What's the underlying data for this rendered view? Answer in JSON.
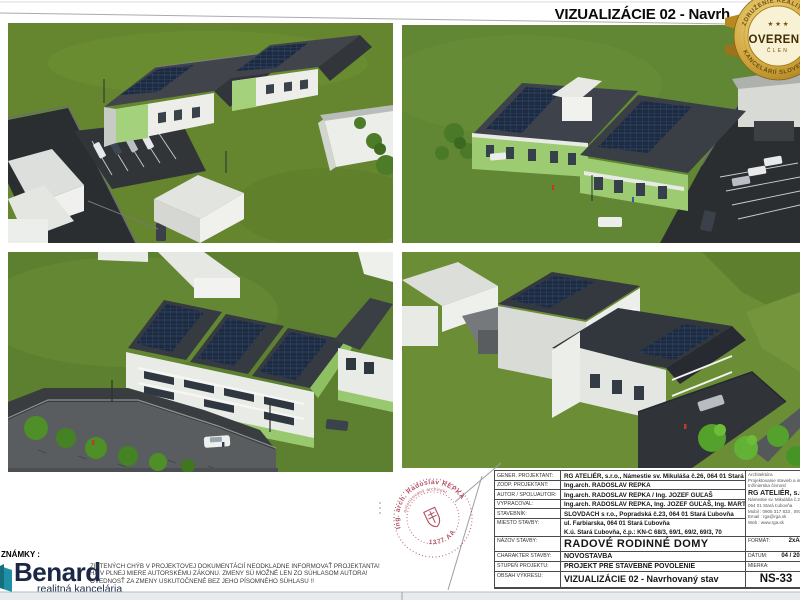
{
  "page": {
    "title": "VIZUALIZÁCIE 02 - Navrh",
    "notes_label": "ZNÁMKY :"
  },
  "badge": {
    "arc_top": "ZDRUŽENIE REALITNÝCH",
    "arc_bottom": "KANCELÁRIÍ SLOVENSKA",
    "stars": "★ ★ ★",
    "center": "OVERENÝ",
    "sub": "ČLEN",
    "gold": "#c79b31"
  },
  "stamp": {
    "arc_top": "Ing. arch. Radoslav REPKA",
    "arc_inner": "autorizovaný architekt",
    "number": "1377 AA",
    "color": "#b35063"
  },
  "title_block": {
    "rows": [
      {
        "label": "GENER. PROJEKTANT:",
        "value": "RG ATELIÉR, s.r.o., Námestie sv. Mikuláša č.26, 064 01 Stará Ľubovňa"
      },
      {
        "label": "ZODP. PROJEKTANT:",
        "value": "Ing.arch. RADOSLAV REPKA"
      },
      {
        "label": "AUTOR / SPOLUAUTOR:",
        "value": "Ing.arch. RADOSLAV REPKA / Ing. JOZEF GUĽAŠ"
      },
      {
        "label": "VYPRACOVAL:",
        "value": "Ing.arch. RADOSLAV REPKA, Ing. JOZEF GUĽAŠ, Ing. MARTIN VÍRA"
      },
      {
        "label": "STAVEBNÍK:",
        "value": "SLOVDACH s r.o., Popradská č.23, 064 01 Stará Ľubovňa"
      },
      {
        "label": "MIESTO STAVBY:",
        "value": "ul. Farbiarska, 064 01 Stará Ľubovňa",
        "value2": "K.ú. Stará Ľubovňa, č.p.: KN-C 68/3, 69/1, 69/2, 69/3, 70"
      }
    ],
    "bottom_rows": [
      {
        "label": "NÁZOV STAVBY:",
        "value": "RADOVÉ RODINNÉ DOMY",
        "right_label": "FORMÁT:",
        "right_value": "2xA4"
      },
      {
        "label": "CHARAKTER STAVBY:",
        "value": "NOVOSTAVBA",
        "right_label": "DÁTUM:",
        "right_value": "04 / 202"
      },
      {
        "label": "STUPEŇ PROJEKTU:",
        "value": "PROJEKT PRE STAVEBNÉ POVOLENIE",
        "right_label": "MIERKA:",
        "right_value": ""
      },
      {
        "label": "OBSAH VÝKRESU:",
        "value": "VIZUALIZÁCIE 02 - Navrhovaný stav",
        "drawing_number": "NS-33"
      }
    ],
    "firm": {
      "services": [
        "Architektúra",
        "Projektovanie stavieb a inter",
        "Inžinierska činnosť"
      ],
      "name": "RG ATELIÉR, s.r.o.",
      "address1": "Námestie sv. Mikuláša č.26",
      "address2": "064 01 Stará Ľubovňa",
      "mobile": "Mobil : 0905 317 833 , 0915 9",
      "email": "Email : rga@rga.sk",
      "web": "Web : www.rga.sk"
    }
  },
  "benard": {
    "name": "Benard",
    "tagline": "realitná kancelária",
    "teal": "#1f8fa3",
    "navy": "#1a2746"
  },
  "disclaimer": [
    "ZISTENÝCH CHÝB V PROJEKTOVEJ DOKUMENTÁCIÍ NEODKLADNE INFORMOVAŤ PROJEKTANTA!",
    "HA V PLNEJ MIERE AUTORSKÉMU ZÁKONU. ZMENY SÚ MOŽNÉ LEN ZO SÚHLASOM AUTORA!",
    "OVEDNOSŤ ZA ZMENY USKUTOČNENÉ BEZ JEHO PÍSOMNÉHO SÚHLASU !!"
  ],
  "colors": {
    "grass": "#65862e",
    "asphalt": "#2b2e30",
    "roof": "#3a3e45",
    "solar": "#1d2a40",
    "facade_green": "#9ecd74",
    "wall_white": "#eef0ec"
  }
}
